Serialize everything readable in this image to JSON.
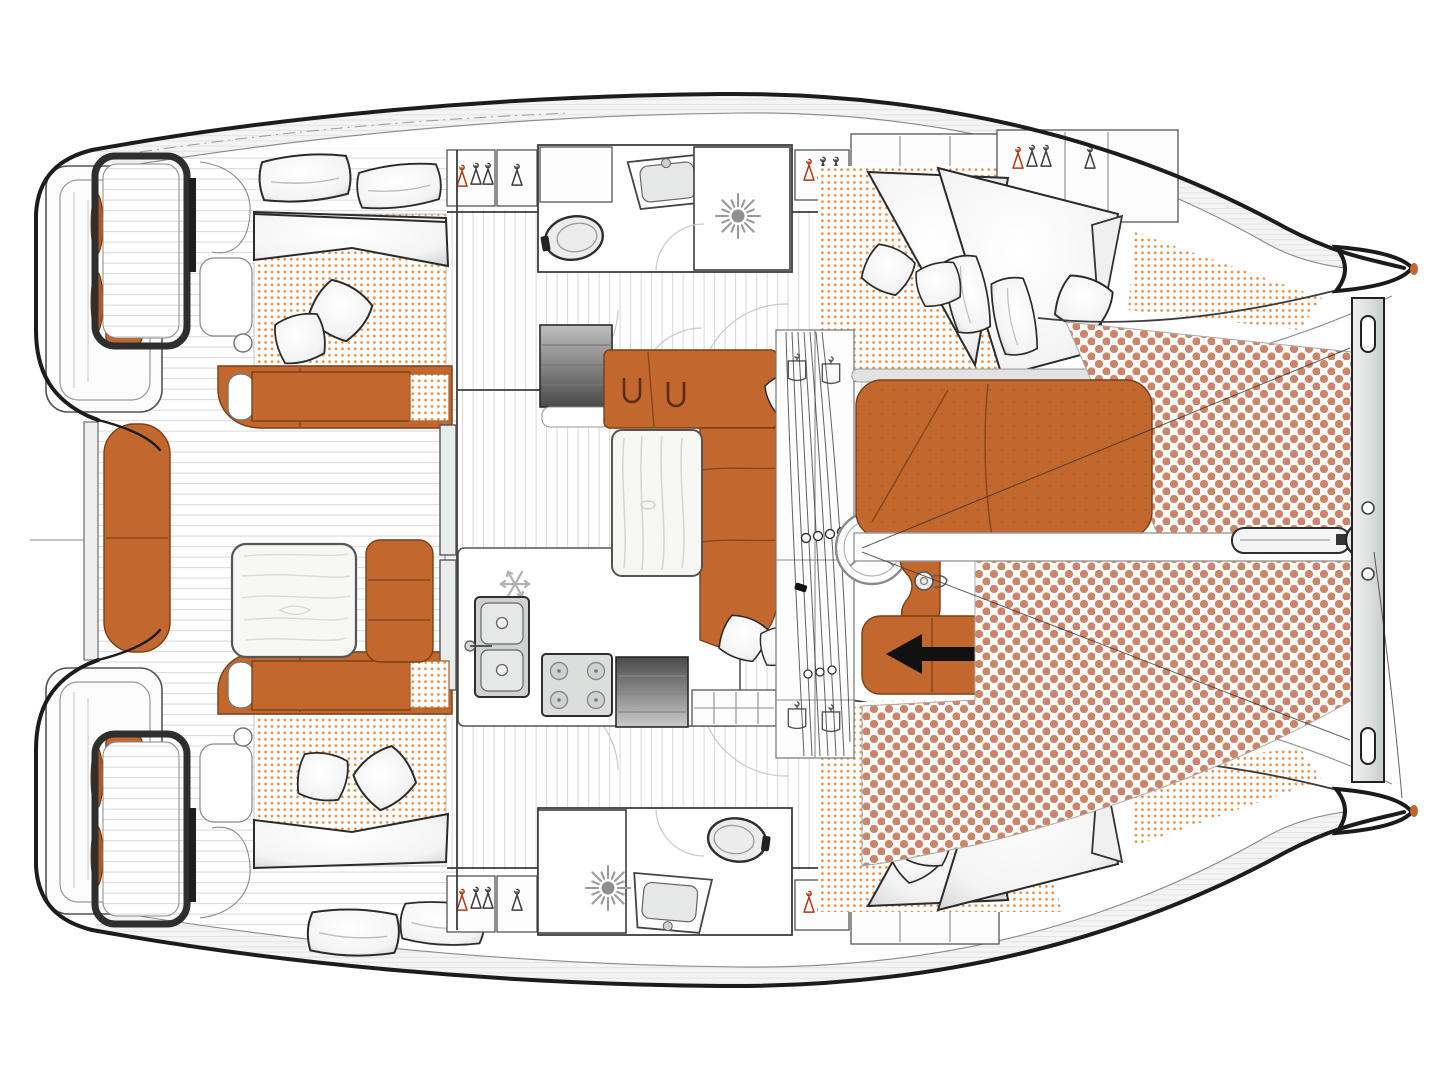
{
  "page": {
    "title": "Catamaran layout plan",
    "background": "#FFFFFF",
    "canvas": {
      "width": 1440,
      "height": 1080
    }
  },
  "diagram": {
    "type": "floor-plan",
    "subject": "Sailing catamaran interior and deck layout, top-down view",
    "orientation": {
      "bow": "right",
      "stern": "left",
      "port_hull": "top",
      "starboard_hull": "bottom"
    },
    "counts": {
      "double_beds": 4,
      "bathroom_blocks": 2,
      "trampoline_panels": 2,
      "companionway_stairs": 2
    }
  },
  "colors": {
    "floor": "#FFFFFF",
    "hull_outline": "#1C1C1C",
    "upholstery": "#C2682F",
    "upholstery_dark": "#B05A23",
    "mattress_dots": "#E2954F",
    "trampoline_dots": "#CC8568",
    "plank_line": "#D9D9D9",
    "steel": "#D9DCDA",
    "stairs_dark": "#4A4A4A",
    "hanger_red": "#B13A12",
    "arrow": "#111111"
  },
  "features": {
    "cockpit": "Cockpit",
    "cockpit_table": "Cockpit table",
    "cockpit_bench_port": "Cockpit bench (port)",
    "cockpit_bench_starboard": "Cockpit bench (starboard)",
    "cockpit_corner_bench": "Cockpit corner bench",
    "aft_sunbed": "Aft sunbed between transoms",
    "transom_port": "Port transom steps",
    "transom_starboard": "Starboard transom steps",
    "helm_bench_port": "Port aft bench with fenders",
    "helm_bench_starboard": "Starboard aft bench with fenders",
    "sliding_door": "Sliding glass door",
    "saloon": "Saloon",
    "saloon_sofa": "Saloon L-shaped sofa",
    "saloon_sideboard": "Saloon sideboard",
    "saloon_table": "Saloon table",
    "galley": "Galley",
    "galley_sink": "Galley double sink",
    "galley_stove": "Four-burner stove",
    "galley_fridge": "Refrigerator (snowflake)",
    "stairs_port": "Companionway steps to port hull",
    "stairs_starboard": "Companionway steps to starboard hull",
    "port_aft_cabin": "Port aft cabin (double bed)",
    "port_bathroom": "Port bathroom (toilet, washbasin)",
    "port_shower": "Port shower",
    "port_wardrobe": "Port wardrobes with hangers",
    "port_forward_cabin": "Port forward cabin (double bed)",
    "starboard_aft_cabin": "Starboard aft cabin (double bed)",
    "starboard_bathroom": "Starboard bathroom (toilet, washbasin)",
    "starboard_shower": "Starboard shower",
    "starboard_wardrobe": "Starboard wardrobes with hangers",
    "starboard_forward_cabin": "Starboard forward cabin (double bed)",
    "mast": "Mast base, halyards and rigging",
    "steering_wheel": "Steering wheel",
    "helm_seat": "Helm seat",
    "forward_bench": "Forward bench with direction arrow",
    "foredeck_sunpad": "Foredeck sunpad",
    "trampoline_port": "Trampoline (port panel)",
    "trampoline_starboard": "Trampoline (starboard panel)",
    "crossbeam": "Forward crossbeam",
    "bowsprit": "Bowsprit and anchor roller",
    "forestay": "Forestay / rigging line"
  },
  "icons": [
    {
      "name": "snowflake-icon",
      "meaning": "refrigerator"
    },
    {
      "name": "shower-drain-icon",
      "meaning": "shower"
    },
    {
      "name": "hanger-icon",
      "meaning": "wardrobe"
    },
    {
      "name": "left-arrow-icon",
      "meaning": "companionway direction"
    },
    {
      "name": "steering-wheel-icon",
      "meaning": "helm"
    }
  ]
}
